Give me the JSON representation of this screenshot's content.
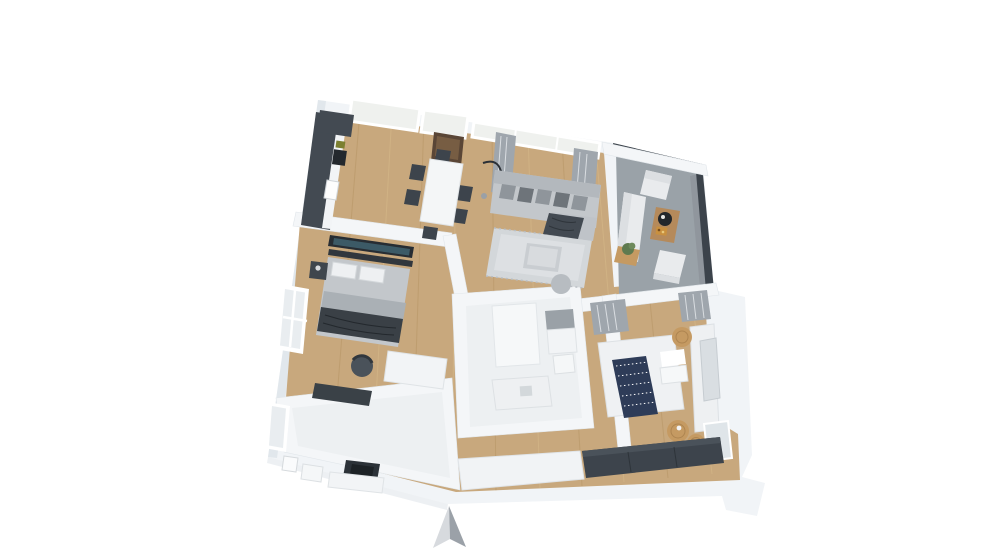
{
  "scene": {
    "type": "3d-floor-plan-render",
    "description": "Isometric 3D rendering of an apartment floor plan on a plain white background, viewed from above at a slight rotation, with a metallic north arrow below the plan",
    "background": "#ffffff",
    "rooms": [
      {
        "id": "kitchen",
        "position": "top-left",
        "furniture": [
          "dark-kitchen-counter-l-shape",
          "white-countertop",
          "sink",
          "cooktop",
          "tilted-windows",
          "dining-table-white",
          "six-dark-chairs",
          "wall-mounted-tv-panel"
        ]
      },
      {
        "id": "living-room",
        "position": "top-center",
        "furniture": [
          "gray-sectional-sofa",
          "throw-pillows",
          "dark-throw-blanket",
          "light-gray-rug",
          "coffee-table",
          "arc-floor-lamp",
          "ottoman",
          "large-windows",
          "gray-curtains"
        ]
      },
      {
        "id": "balcony",
        "position": "top-right",
        "furniture": [
          "dark-glass-railing",
          "gray-deck-floor",
          "white-outdoor-sofa",
          "two-white-armchairs",
          "wood-coffee-table",
          "black-round-tray",
          "snack-tray",
          "potted-plant",
          "wood-side-table"
        ]
      },
      {
        "id": "bedroom-1",
        "position": "middle-left",
        "furniture": [
          "double-bed-gray-bedding",
          "dark-throw",
          "two-pillows",
          "wall-tv-with-landscape-image",
          "dark-nightstand-with-lamp",
          "white-desk",
          "dark-desk-chair",
          "dark-sideboard",
          "left-wall-window"
        ]
      },
      {
        "id": "bathroom-2",
        "position": "center",
        "furniture": [
          "white-tile-floor",
          "walk-in-shower-gray-panel",
          "toilet",
          "white-vanity",
          "open-door-leaf"
        ]
      },
      {
        "id": "bedroom-2",
        "position": "middle-right",
        "furniture": [
          "double-bed-white-bedding",
          "navy-striped-runner",
          "white-pillows",
          "white-headboard-bench",
          "wall-mirror",
          "three-rattan-poufs",
          "gray-curtains",
          "corner-window",
          "dark-wardrobe"
        ]
      },
      {
        "id": "bathroom-1",
        "position": "bottom-left",
        "furniture": [
          "white-tile-floor",
          "toilet",
          "white-vanity",
          "dark-vessel-sink",
          "wall-mirror",
          "left-wall-window"
        ]
      },
      {
        "id": "entry-hall",
        "position": "bottom-center",
        "furniture": [
          "wood-floor",
          "white-sideboard",
          "dark-wardrobe-band",
          "entry-recess"
        ]
      }
    ],
    "compass": {
      "name": "north-arrow",
      "direction": "up",
      "style": "metallic-silver-3d-arrowhead"
    }
  },
  "colors": {
    "background": "#ffffff",
    "wall": "#f1f4f7",
    "wall_inner": "#f7f9fa",
    "wall_shade": "#dde3e9",
    "wood_floor": "#c8a87d",
    "bath_floor": "#edf0f2",
    "balcony_floor": "#9aa2a8",
    "railing_dark": "#3c434b",
    "furniture_dark": "#3d444c",
    "sofa_gray": "#c3c7cb",
    "rug_gray": "#d3d7da",
    "bed_white": "#eff1f3",
    "navy": "#2e3c58",
    "rattan": "#c59a62",
    "wood_furniture": "#b58a5b",
    "tv_copper": "#5a4636",
    "glass": "#eff1ee",
    "curtain": "#9fa6ad",
    "arrow_light": "#d7dade",
    "arrow_dark": "#9ba1a8"
  }
}
